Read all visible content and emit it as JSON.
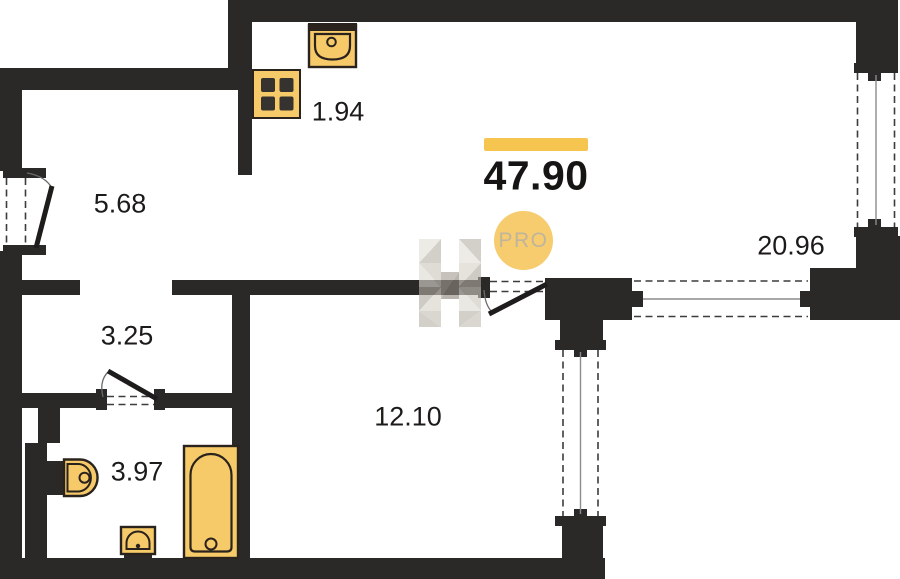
{
  "title": "Apartment floor plan",
  "total": {
    "value": "47.90",
    "badge_label": "PRO"
  },
  "rooms": [
    {
      "id": "entry-hall",
      "area": "5.68"
    },
    {
      "id": "kitchen-niche",
      "area": "1.94"
    },
    {
      "id": "corridor",
      "area": "3.25"
    },
    {
      "id": "bathroom",
      "area": "3.97"
    },
    {
      "id": "bedroom",
      "area": "12.10"
    },
    {
      "id": "living-room",
      "area": "20.96"
    }
  ],
  "icons": [
    "kitchen-sink-icon",
    "stove-icon",
    "toilet-icon",
    "bath-sink-icon",
    "bathtub-icon",
    "pro-badge",
    "brand-watermark-icon"
  ],
  "colors": {
    "wall": "#2b2928",
    "accent_yellow": "#f5c54f",
    "fixture_yellow": "#f7ca69",
    "badge_yellow": "#f7cc6e",
    "badge_text": "#bfb49e",
    "label_text": "#1c1b1a"
  }
}
